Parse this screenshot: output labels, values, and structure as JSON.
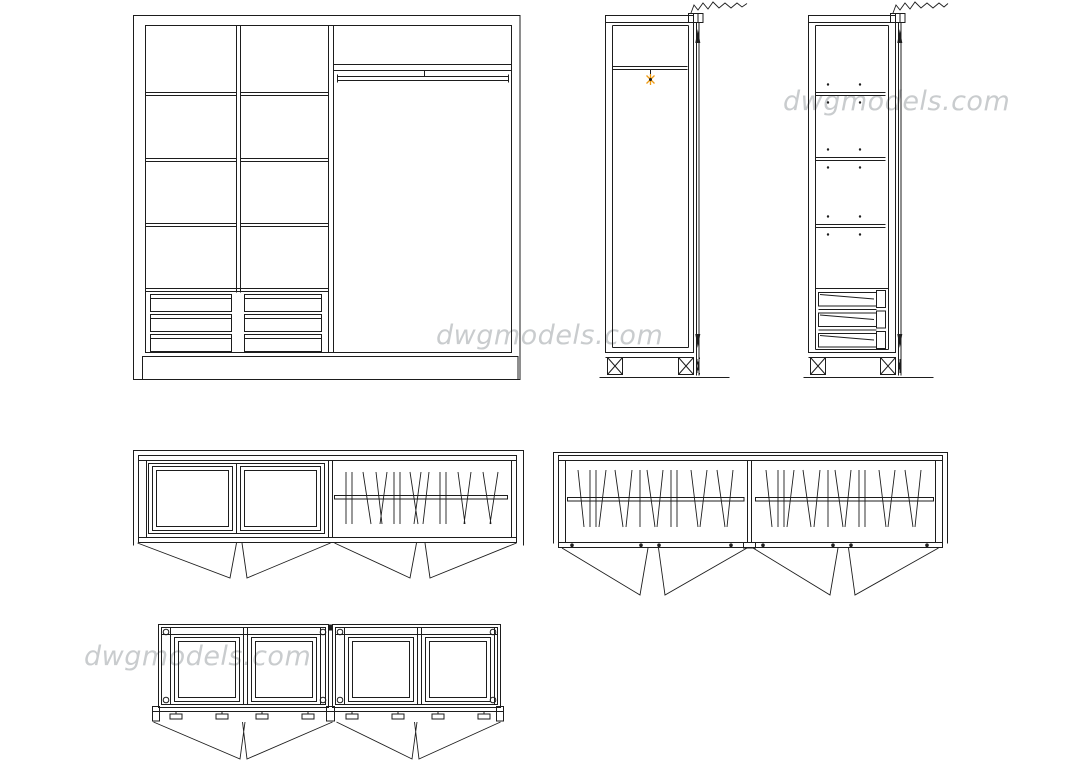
{
  "canvas": {
    "width": 1080,
    "height": 760,
    "background": "#ffffff"
  },
  "watermark": {
    "text": "dwgmodels.com",
    "color": "#c7cacc"
  },
  "colors": {
    "line": "#1d1d1d",
    "accent": "#ef9b13",
    "wm": "#c7cacc"
  },
  "views": [
    {
      "name": "front-elevation"
    },
    {
      "name": "side-section-with-hanger-hook"
    },
    {
      "name": "side-section-with-shelves-and-drawers"
    },
    {
      "name": "top-plan-shelves-plus-hanging"
    },
    {
      "name": "top-plan-two-hanging-sections"
    },
    {
      "name": "top-plan-framed-door-modules"
    }
  ],
  "icons": {
    "hanger_hook": "orange starburst point marker",
    "wall_break": "zigzag break line"
  }
}
